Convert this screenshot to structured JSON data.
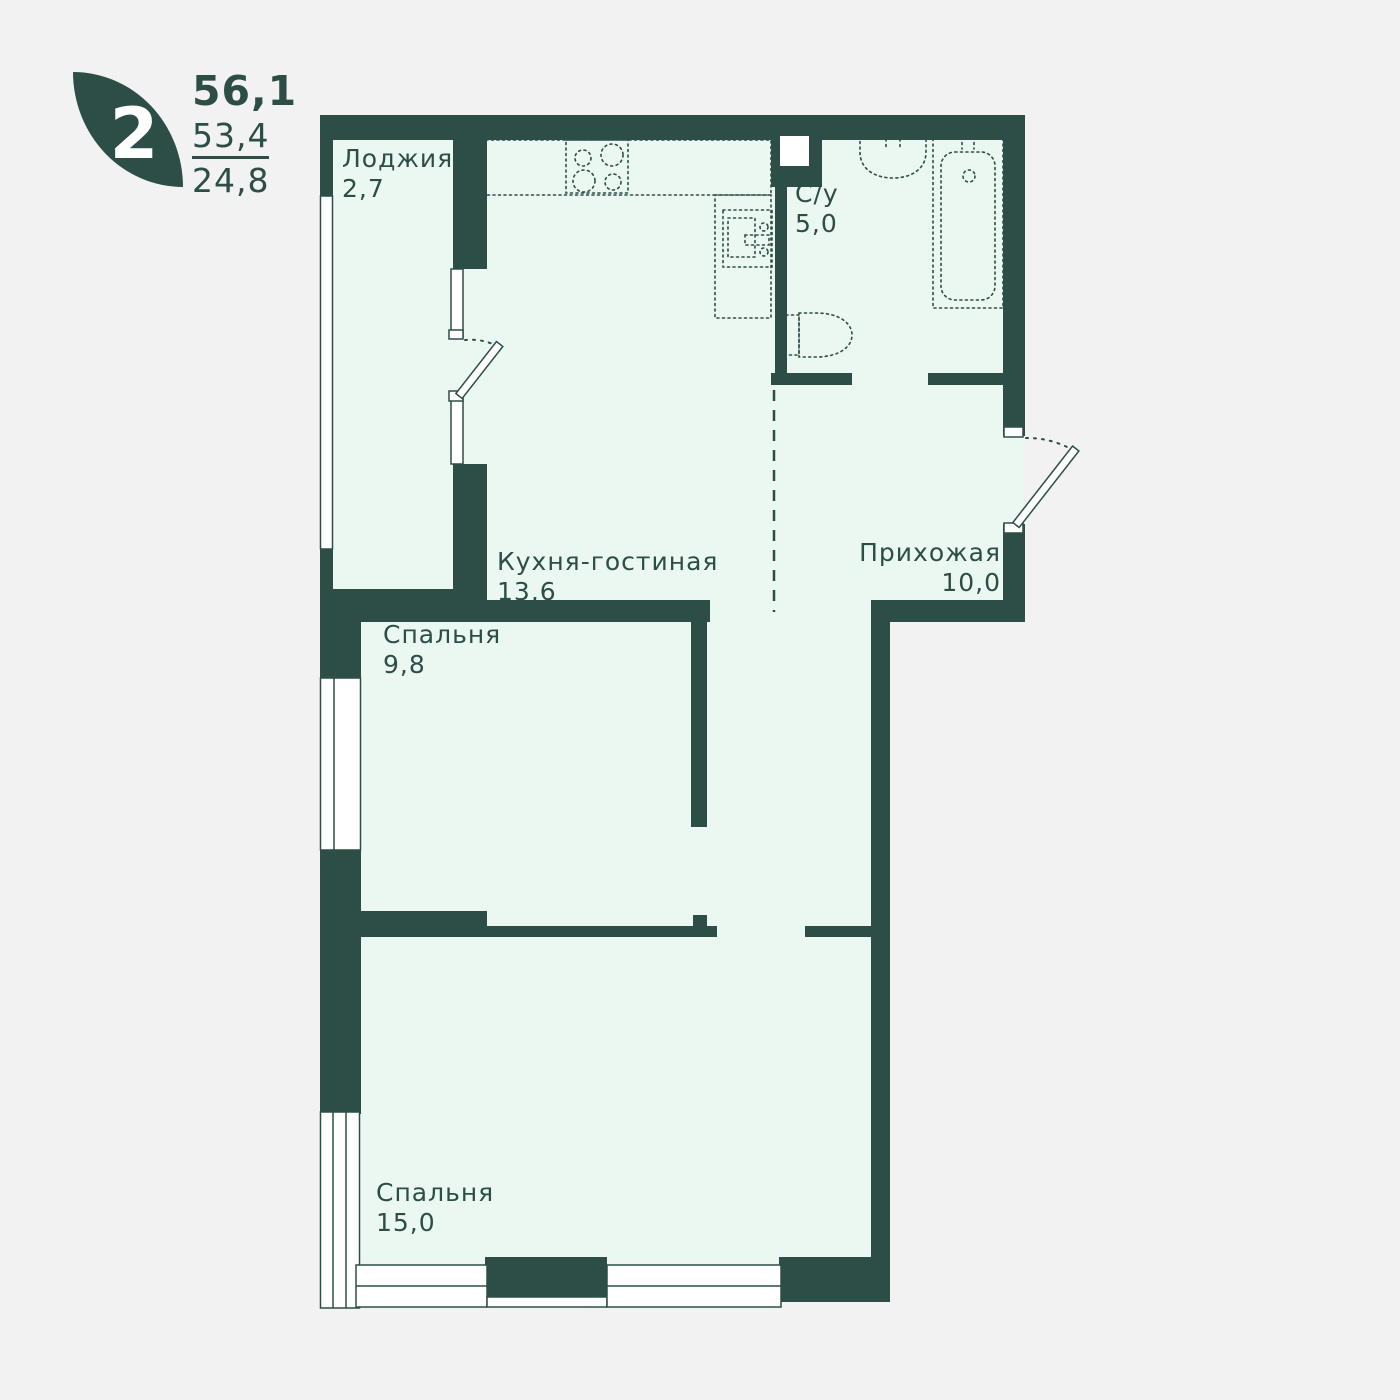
{
  "badge": {
    "rooms": "2",
    "area_total": "56,1",
    "area_living": "53,4",
    "area_other": "24,8"
  },
  "rooms": {
    "loggia": {
      "name": "Лоджия",
      "area": "2,7"
    },
    "kitchen_living": {
      "name": "Кухня-гостиная",
      "area": "13,6"
    },
    "bathroom": {
      "name": "С/у",
      "area": "5,0"
    },
    "hallway": {
      "name": "Прихожая",
      "area": "10,0"
    },
    "bedroom_small": {
      "name": "Спальня",
      "area": "9,8"
    },
    "bedroom_large": {
      "name": "Спальня",
      "area": "15,0"
    }
  },
  "colors": {
    "wall": "#2c4e46",
    "floor": "#eaf8f1",
    "background": "#f2f2f2",
    "window": "#ffffff"
  }
}
